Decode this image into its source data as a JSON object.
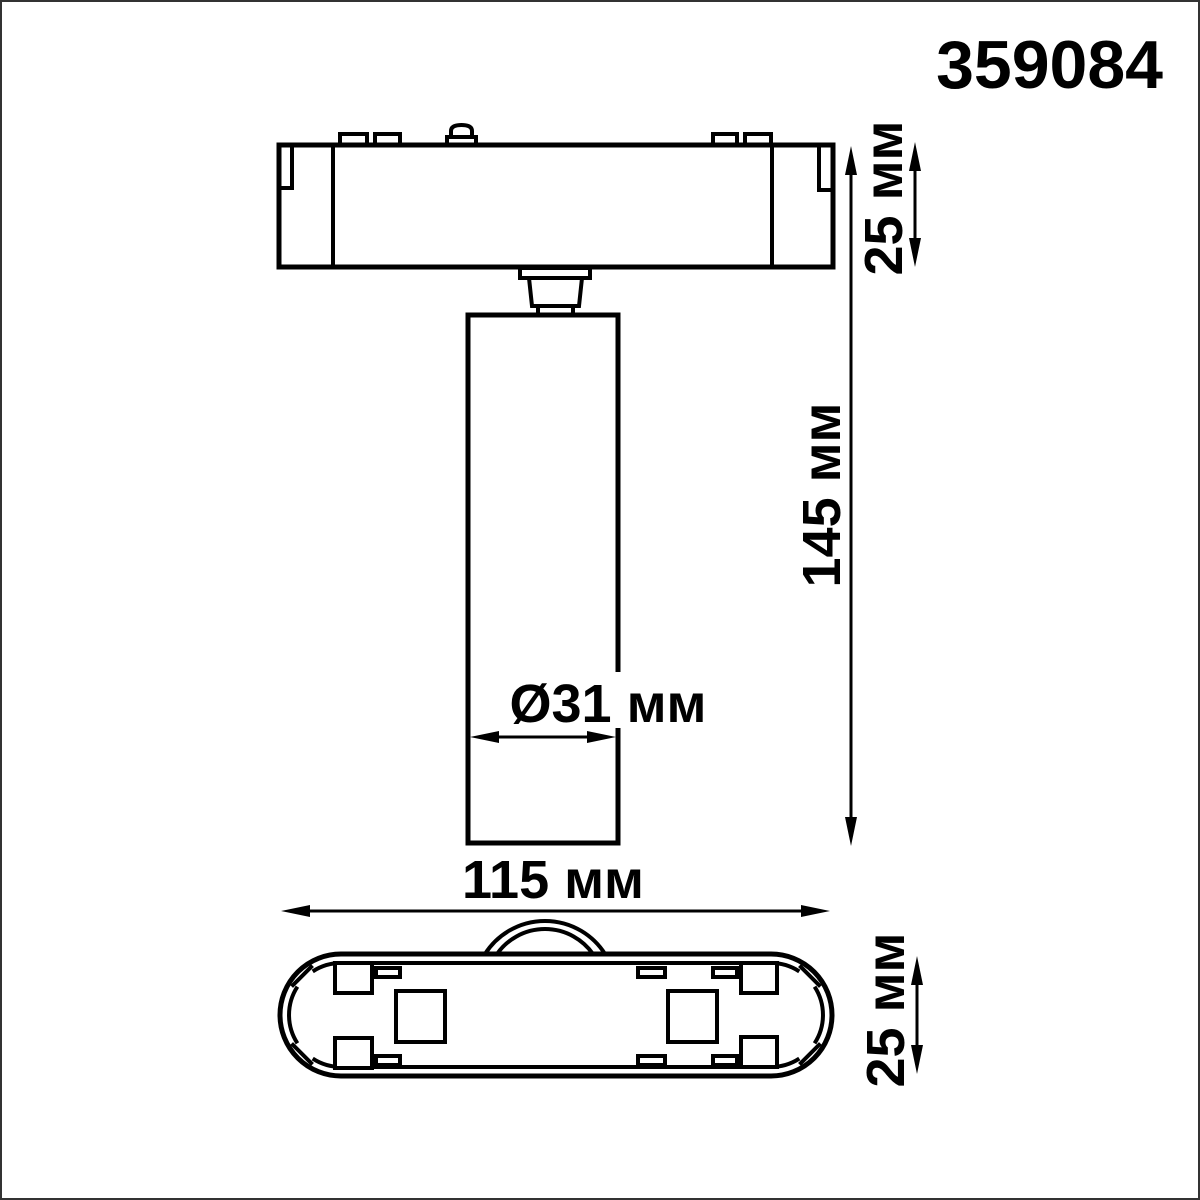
{
  "page": {
    "background": "#ffffff",
    "frame_color": "#333333"
  },
  "product": {
    "article": "359084"
  },
  "drawing": {
    "line_color": "#000000",
    "unit": "мм",
    "dimensions": {
      "track_module_height": {
        "label": "25 мм",
        "value": 25,
        "unit": "мм"
      },
      "overall_height": {
        "label": "145 мм",
        "value": 145,
        "unit": "мм"
      },
      "spot_diameter": {
        "label": "Ø31 мм",
        "value": 31,
        "unit": "мм"
      },
      "module_length": {
        "label": "115 мм",
        "value": 115,
        "unit": "мм"
      },
      "base_depth": {
        "label": "25 мм",
        "value": 25,
        "unit": "мм"
      }
    }
  }
}
